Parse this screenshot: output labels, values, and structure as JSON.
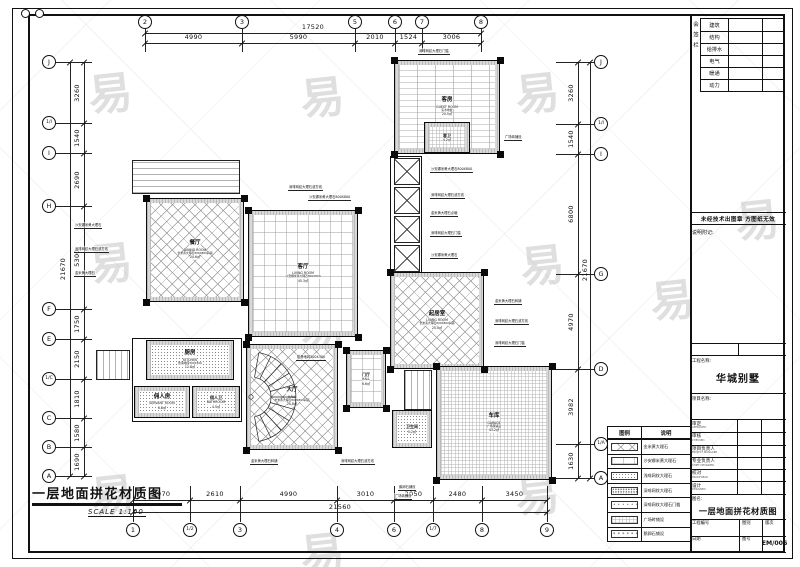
{
  "sheet": {
    "watermark_char": "易",
    "line_color": "#111111",
    "bg_color": "#ffffff"
  },
  "plan_title": {
    "text": "一层地面拼花材质图",
    "scale": "SCALE 1:100"
  },
  "grid": {
    "top": {
      "overall": "17520",
      "labels": [
        "2",
        "3",
        "5",
        "6",
        "7",
        "8"
      ],
      "x": [
        145,
        242,
        355,
        395,
        422,
        481
      ],
      "dims": [
        "4990",
        "5990",
        "2010",
        "1524",
        "3006"
      ]
    },
    "bottom": {
      "overall": "21560",
      "labels": [
        "1",
        "1/2",
        "3",
        "4",
        "6",
        "1/7",
        "8",
        "9"
      ],
      "x": [
        133,
        190,
        240,
        337,
        394,
        433,
        482,
        547
      ],
      "dims": [
        "2970",
        "2610",
        "4990",
        "3010",
        "2050",
        "2480",
        "3450"
      ]
    },
    "left": {
      "overall": "21670",
      "labels": [
        "J",
        "1/I",
        "I",
        "H",
        "F",
        "E",
        "1/C",
        "C",
        "B",
        "A"
      ],
      "y": [
        62,
        123,
        153,
        206,
        309,
        339,
        379,
        418,
        447,
        476
      ],
      "dims": [
        "3260",
        "1540",
        "2690",
        "5300",
        "1750",
        "2150",
        "1810",
        "1580",
        "1690"
      ]
    },
    "right": {
      "overall": "21670",
      "labels": [
        "J",
        "1/I",
        "I",
        "G",
        "D",
        "1/A",
        "A"
      ],
      "y": [
        62,
        124,
        154,
        274,
        369,
        444,
        478
      ],
      "dims": [
        "3260",
        "1540",
        "6800",
        "4970",
        "3982",
        "1630"
      ]
    }
  },
  "plan": {
    "rooms": [
      {
        "id": "dining",
        "name": "餐厅",
        "en": "DINING ROOM",
        "spec": "金米黄大理石800X800斜铺",
        "area": "24.6㎡",
        "x": 146,
        "y": 198,
        "w": 98,
        "h": 104,
        "pattern": "diamond"
      },
      {
        "id": "living",
        "name": "客厅",
        "en": "LIVING ROOM",
        "spec": "沙安娜米黄大理石800X800",
        "area": "45.3㎡",
        "x": 248,
        "y": 210,
        "w": 110,
        "h": 127,
        "pattern": "grid"
      },
      {
        "id": "family",
        "name": "起居室",
        "en": "LIVING ROOM",
        "spec": "金米黄大理石800X800斜铺",
        "area": "25.0㎡",
        "x": 390,
        "y": 272,
        "w": 94,
        "h": 97,
        "pattern": "diamond"
      },
      {
        "id": "guest",
        "name": "客房",
        "en": "GUEST ROOM",
        "spec": "实木地板",
        "area": "20.5㎡",
        "x": 394,
        "y": 60,
        "w": 106,
        "h": 94,
        "pattern": "wood"
      },
      {
        "id": "guest-bath",
        "name": "客卫",
        "en": "",
        "spec": "",
        "area": "4.2㎡",
        "x": 424,
        "y": 122,
        "w": 46,
        "h": 31,
        "pattern": "finegrid"
      },
      {
        "id": "kitchen",
        "name": "厨房",
        "en": "KITCHEN",
        "spec": "防滑地砖300X300",
        "area": "12.8㎡",
        "x": 146,
        "y": 340,
        "w": 88,
        "h": 40,
        "pattern": "dots"
      },
      {
        "id": "servant",
        "name": "佣人房",
        "en": "SERVANT ROOM",
        "spec": "",
        "area": "6.8㎡",
        "x": 134,
        "y": 386,
        "w": 56,
        "h": 32,
        "pattern": "dots"
      },
      {
        "id": "servant-bath",
        "name": "佣人卫",
        "en": "BATHROOM",
        "spec": "",
        "area": "4.5㎡",
        "x": 192,
        "y": 386,
        "w": 48,
        "h": 32,
        "pattern": "dots"
      },
      {
        "id": "stair-hall",
        "name": "大厅",
        "en": "HALL",
        "spec": "金米黄大理石800X800斜铺",
        "area": "25.8㎡",
        "x": 246,
        "y": 344,
        "w": 92,
        "h": 106,
        "pattern": "diamond"
      },
      {
        "id": "entry-hall",
        "name": "门厅",
        "en": "HALL",
        "spec": "",
        "area": "6.6㎡",
        "x": 346,
        "y": 350,
        "w": 40,
        "h": 58,
        "pattern": "grid"
      },
      {
        "id": "garage",
        "name": "车库",
        "en": "GARAGE",
        "spec": "广场砖铺设",
        "area": "43.2㎡",
        "x": 436,
        "y": 366,
        "w": 116,
        "h": 114,
        "pattern": "finegrid"
      },
      {
        "id": "toilet",
        "name": "卫生间",
        "en": "",
        "spec": "",
        "area": "5.2㎡",
        "x": 392,
        "y": 410,
        "w": 40,
        "h": 38,
        "pattern": "dots"
      }
    ],
    "columns": [
      [
        146,
        198
      ],
      [
        244,
        198
      ],
      [
        146,
        302
      ],
      [
        244,
        302
      ],
      [
        248,
        210
      ],
      [
        358,
        210
      ],
      [
        248,
        337
      ],
      [
        358,
        337
      ],
      [
        390,
        272
      ],
      [
        484,
        272
      ],
      [
        390,
        369
      ],
      [
        484,
        369
      ],
      [
        394,
        60
      ],
      [
        500,
        60
      ],
      [
        394,
        154
      ],
      [
        500,
        154
      ],
      [
        246,
        344
      ],
      [
        338,
        344
      ],
      [
        246,
        450
      ],
      [
        338,
        450
      ],
      [
        436,
        366
      ],
      [
        552,
        366
      ],
      [
        436,
        480
      ],
      [
        552,
        480
      ],
      [
        346,
        350
      ],
      [
        386,
        350
      ],
      [
        346,
        408
      ],
      [
        386,
        408
      ]
    ],
    "xboxes": [
      [
        394,
        158
      ],
      [
        394,
        187
      ],
      [
        394,
        216
      ],
      [
        394,
        245
      ]
    ],
    "extras": [
      {
        "type": "deckh",
        "x": 132,
        "y": 160,
        "w": 108,
        "h": 34
      },
      {
        "type": "deckv",
        "x": 96,
        "y": 350,
        "w": 34,
        "h": 30
      },
      {
        "type": "outl",
        "x": 390,
        "y": 156,
        "w": 32,
        "h": 118
      },
      {
        "type": "deckv",
        "x": 404,
        "y": 370,
        "w": 28,
        "h": 40
      },
      {
        "type": "outl",
        "x": 132,
        "y": 338,
        "w": 110,
        "h": 84
      }
    ],
    "annotations": [
      {
        "text": "深啡网纹大理石门槛",
        "x": 418,
        "y": 48
      },
      {
        "text": "广场砖铺设",
        "x": 504,
        "y": 134
      },
      {
        "text": "深啡网纹大理石波打线",
        "x": 288,
        "y": 184
      },
      {
        "text": "沙安娜米黄大理石800X800",
        "x": 308,
        "y": 194
      },
      {
        "text": "沙安娜米黄大理石",
        "x": 74,
        "y": 222
      },
      {
        "text": "深啡网纹大理石波打线",
        "x": 74,
        "y": 246
      },
      {
        "text": "金米黄大理石",
        "x": 74,
        "y": 270
      },
      {
        "text": "沙安娜米黄大理石800X800",
        "x": 430,
        "y": 166
      },
      {
        "text": "深啡网纹大理石波打线",
        "x": 430,
        "y": 192
      },
      {
        "text": "金米黄大理石点缀",
        "x": 430,
        "y": 210
      },
      {
        "text": "深啡网纹大理石门槛",
        "x": 430,
        "y": 230
      },
      {
        "text": "沙安娜米黄大理石",
        "x": 430,
        "y": 252
      },
      {
        "text": "金米黄大理石斜铺",
        "x": 494,
        "y": 298
      },
      {
        "text": "深啡网纹大理石波打线",
        "x": 494,
        "y": 318
      },
      {
        "text": "深啡网纹大理石门槛",
        "x": 494,
        "y": 340
      },
      {
        "text": "防滑地砖300X300",
        "x": 296,
        "y": 354
      },
      {
        "text": "金米黄大理石斜铺",
        "x": 250,
        "y": 458
      },
      {
        "text": "深啡网纹大理石波打线",
        "x": 340,
        "y": 458
      },
      {
        "text": "鹅卵石铺设",
        "x": 398,
        "y": 484
      },
      {
        "text": "广场砖铺设",
        "x": 394,
        "y": 493
      }
    ]
  },
  "legend": {
    "col_headers": [
      "图例",
      "说明"
    ],
    "rows": [
      {
        "pattern": "diamond",
        "label": "金米黄大理石"
      },
      {
        "pattern": "grid",
        "label": "沙安娜米黄大理石"
      },
      {
        "pattern": "dots",
        "label": "浅啡网纹大理石"
      },
      {
        "pattern": "dots-dark",
        "label": "深啡网纹大理石"
      },
      {
        "pattern": "dots-sparse",
        "label": "深啡网纹大理石门槛"
      },
      {
        "pattern": "finegrid",
        "label": "广场砖铺设"
      },
      {
        "pattern": "pebble",
        "label": "鹅卵石铺设"
      }
    ]
  },
  "title_block": {
    "side_strip_label": "会签栏",
    "disciplines": [
      "建筑",
      "结构",
      "给排水",
      "电气",
      "暖通",
      "动力"
    ],
    "seal_note": "未经技术出图章 方图纸无效",
    "remark_label": "说明附记:",
    "project_name_label": "工程名称:",
    "project_name": "华城别墅",
    "subproject_label": "项目名称:",
    "sign_rows": [
      {
        "label": "审定",
        "en": "APPROVED"
      },
      {
        "label": "审核",
        "en": "CHECKED"
      },
      {
        "label": "项目负责人",
        "en": "PROJECT MANAGER"
      },
      {
        "label": "专业负责人",
        "en": "CHIEF DESIGNER"
      },
      {
        "label": "校对",
        "en": "PROOFREAD"
      },
      {
        "label": "设计",
        "en": "DESIGNED"
      }
    ],
    "drawing_name_label": "图名:",
    "drawing_name": "一层地面拼花材质图",
    "bottom_cells": [
      "工程编号",
      "图别",
      "版次",
      "日期",
      "图号",
      "EM/006"
    ]
  }
}
